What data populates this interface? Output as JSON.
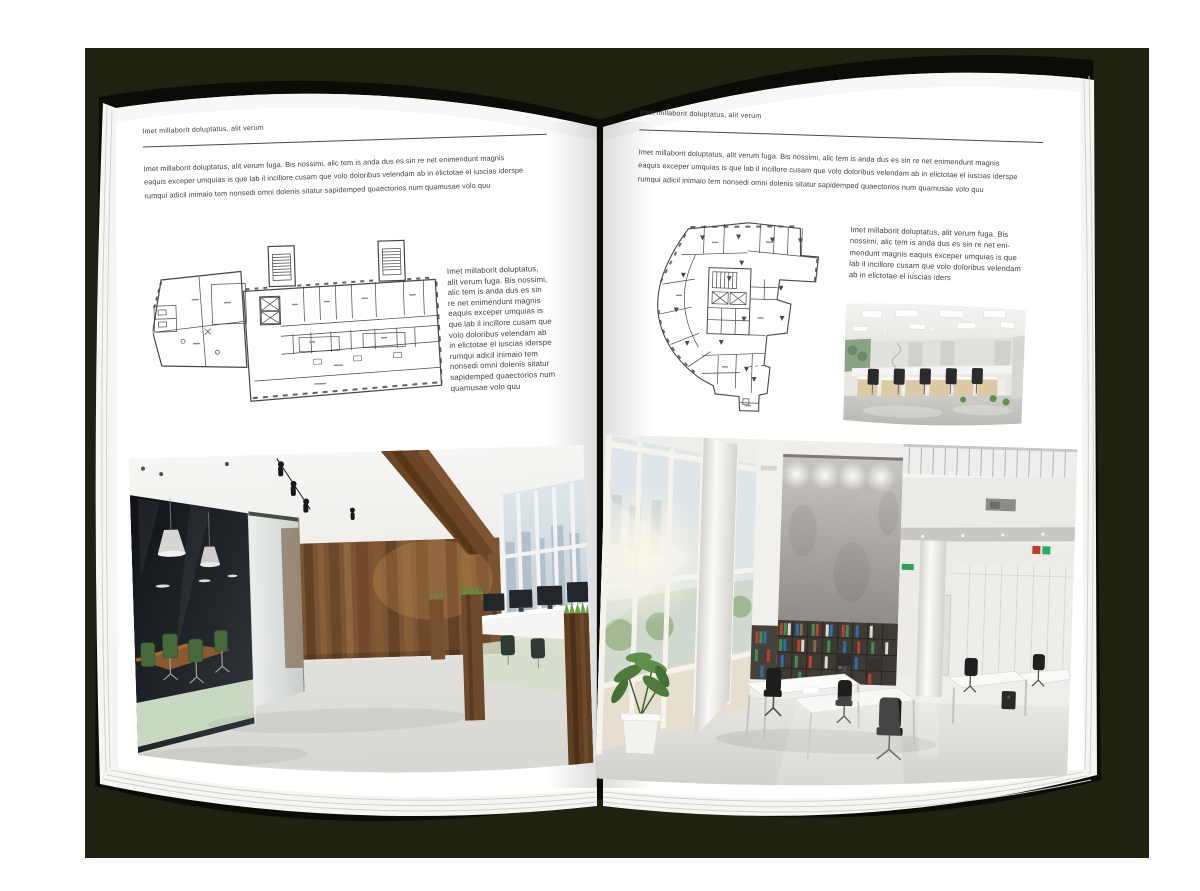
{
  "document": {
    "type": "magazine-spread-mockup",
    "colors": {
      "outer_background": "#ffffff",
      "backdrop": "#1e2211",
      "book_cover": "#0a0c05",
      "page": "#ffffff",
      "heading_text": "#3d3d3d",
      "body_text": "#404040",
      "header_rule": "#4a4a4a"
    }
  },
  "left_page": {
    "header": "Imet millaborit doluptatus, alit verum",
    "intro_lines": [
      "Imet millaborit doluptatus, alit verum fuga. Bis nossimi, alic tem is anda dus es sin re net enimendunt magnis",
      "eaquis exceper umquias is que lab il incillore cusam que volo doloribus velendam ab in elictotae el iuscias iderspe",
      "rumqui adicil inimaio tem nonsedi omni dolenis sitatur sapidemped quaectorios num quamusae volo quu"
    ],
    "side_column_lines": [
      "Imet millaborit doluptatus,",
      "alit verum fuga. Bis nossimi,",
      "alic tem is anda dus es sin",
      "re net enimendunt magnis",
      "eaquis exceper umquias is",
      "que lab il incillore cusam que",
      "volo doloribus velendam ab",
      "in elictotae el iuscias iderspe",
      "rumqui adicil inimaio tem",
      "nonsedi omni dolenis sitatur",
      "sapidemped quaectorios num",
      "quamusae volo quu"
    ],
    "floor_plan_label": "floor-plan-wide-block-two-stair-towers",
    "photo_label": "office-interior-wood-wall-glass-meeting-room"
  },
  "right_page": {
    "header": "Imet millaborit doluptatus, alit verum",
    "intro_lines": [
      "Imet millaborit doluptatus, alit verum fuga. Bis nossimi, alic tem is anda dus es sin re net enimendunt magnis",
      "eaquis exceper umquias is que lab il incillore cusam que volo doloribus velendam ab in elictotae el iuscias iderspe",
      "rumqui adicil inimaio tem nonsedi omni dolenis sitatur sapidemped quaectorios num quamusae volo quu"
    ],
    "side_column_lines": [
      "Imet millaborit doluptatus, alit verum fuga. Bis",
      "nossimi, alic tem is anda dus es sin re net eni-",
      "mendunt magnis eaquis exceper umquias is que",
      "lab il incillore cusam que volo doloribus velendam",
      "ab in elictotae el iuscias iders"
    ],
    "floor_plan_label": "floor-plan-irregular-tower-footprint",
    "photo_small_label": "open-plan-office-workstations",
    "photo_large_label": "double-height-office-atrium"
  }
}
